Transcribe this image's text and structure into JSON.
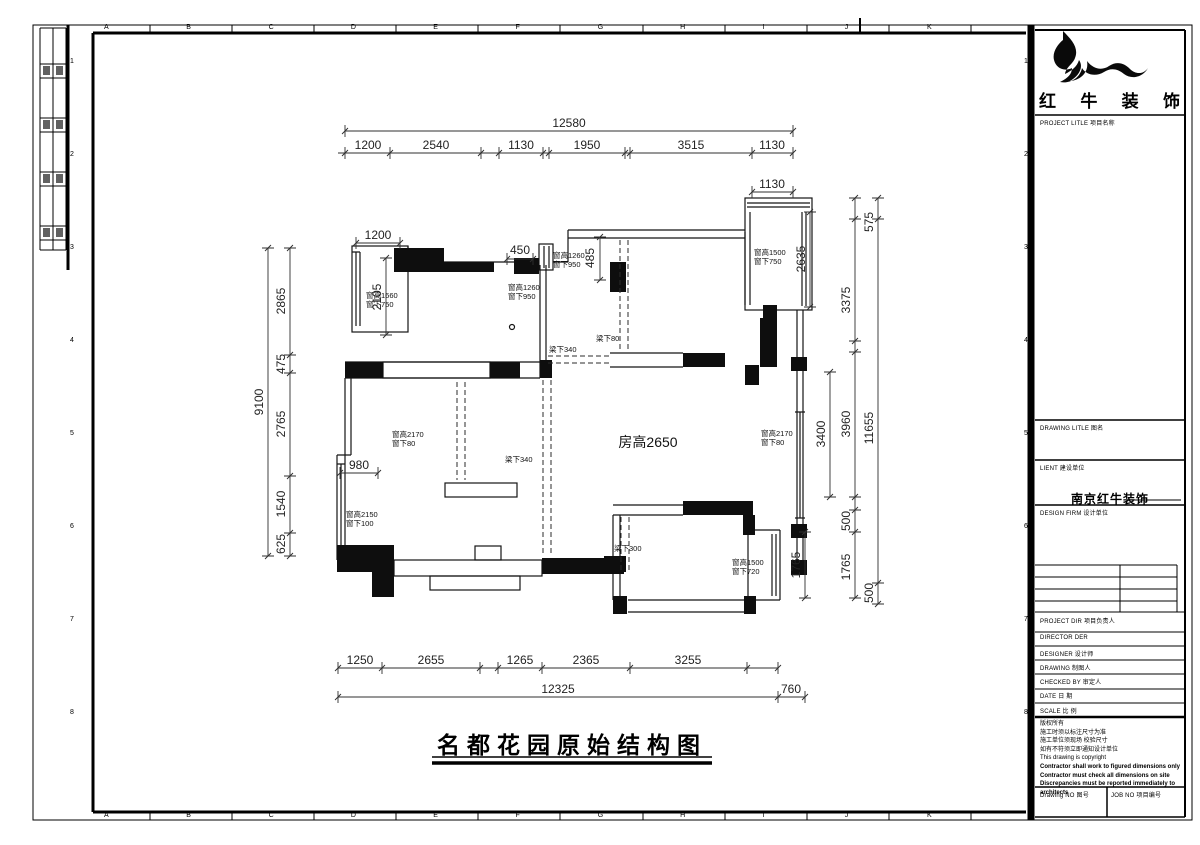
{
  "sheet": {
    "ruler_letters": [
      "A",
      "B",
      "C",
      "D",
      "E",
      "F",
      "G",
      "H",
      "I",
      "J",
      "K"
    ],
    "ruler_numbers": [
      "1",
      "2",
      "3",
      "4",
      "5",
      "6",
      "7",
      "8"
    ]
  },
  "title": {
    "text": "名都花园原始结构图"
  },
  "plan": {
    "room_height": "房高2650",
    "dims_top": {
      "overall": "12580",
      "segments": [
        "1200",
        "2540",
        "1130",
        "1950",
        "3515",
        "1130"
      ],
      "balcony": "1130"
    },
    "dims_bottom": {
      "overall": "12325",
      "segments": [
        "1250",
        "2655",
        "1265",
        "2365",
        "3255"
      ],
      "right": "760"
    },
    "dims_left": {
      "overall": "9100",
      "segments": [
        "2865",
        "475",
        "2765",
        "1540",
        "625"
      ]
    },
    "dims_right": {
      "balcony_h": "2635",
      "living_h": "3400",
      "col2": [
        "3375",
        "3960",
        "500",
        "1765"
      ],
      "col3": [
        "575",
        "11655",
        "500"
      ],
      "bay_h": "1765"
    },
    "dims_inner": {
      "balcony_w": "1200",
      "balcony_h": "2105",
      "win_w": "450",
      "entry": "485",
      "alcove": "980"
    },
    "window_labels": [
      {
        "line1": "窗高1660",
        "line2": "窗下750"
      },
      {
        "line1": "窗高1260",
        "line2": "窗下950"
      },
      {
        "line1": "窗高1260",
        "line2": "窗下950"
      },
      {
        "line1": "窗高1500",
        "line2": "窗下750"
      },
      {
        "line1": "窗高2170",
        "line2": "窗下80"
      },
      {
        "line1": "窗高2150",
        "line2": "窗下100"
      },
      {
        "line1": "窗高2170",
        "line2": "窗下80"
      },
      {
        "line1": "窗高1500",
        "line2": "窗下720"
      }
    ],
    "beam_labels": [
      "梁下340",
      "梁下80",
      "梁下340",
      "梁下300"
    ]
  },
  "titleblock": {
    "logo_chars": [
      "红",
      "牛",
      "装",
      "饰"
    ],
    "project_title_label": "PROJECT LITLE  项目名称",
    "drawing_title_label": "DRAWING LITLE  图名",
    "client_label": "LIENT  建设单位",
    "design_firm_label": "DESIGN FIRM  设计单位",
    "design_firm_value": "南京红牛装饰",
    "project_dir_label": "PROJECT DIR   项目负责人",
    "director_label": "DIRECTOR DER",
    "designer_label": "DESIGNER    设计师",
    "drawing_label": "DRAWING    制图人",
    "checked_label": "CHECKED BY   审定人",
    "date_label": "DATE      日 期",
    "scale_label": "SCALE     比 例",
    "copyright_lines": [
      "版权所有",
      "施工时须以标注尺寸为准",
      "施工单位须现场 校验尺寸",
      "如有不符须立即通知设计单位",
      "This drawing is copyright",
      "Contractor shall work to figured dimensions only",
      "Contractor must check all dimensions on site",
      "Discrepancies must be reported immediately to architects"
    ],
    "drawing_no_label": "Drawing NO 图号",
    "job_no_label": "JOB NO 项目编号"
  }
}
